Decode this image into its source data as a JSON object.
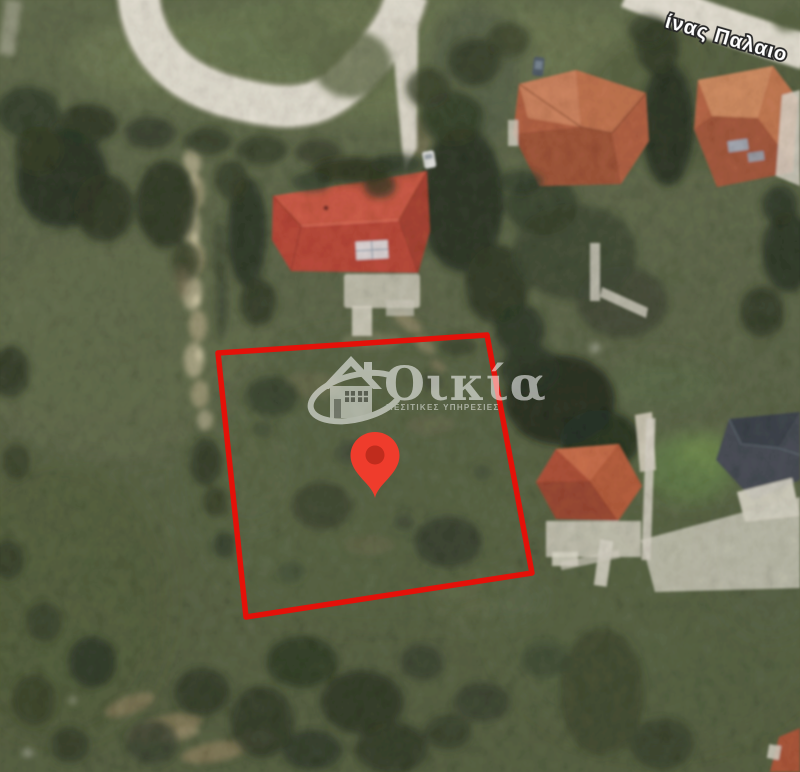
{
  "map": {
    "type": "satellite-aerial-view",
    "street_label": "ίνας Παλαιο",
    "parcel_outline": {
      "points": "218,353 487,335 532,573 246,617",
      "color": "#e41109"
    },
    "pin": {
      "transform": "translate(375,460)",
      "color": "#ef3c2c",
      "inner_color": "#ba2a1c"
    }
  },
  "watermark": {
    "brand": "Οικία",
    "subtitle": "ΜΕΣΙΤΙΚΕΣ ΥΠΗΡΕΣΙΕΣ",
    "color": "#ffffff",
    "icon": "house-logo-icon"
  },
  "palette": {
    "terrain_green": "#57623f",
    "road_beige": "#e4dfd0",
    "main_roof_red": "#c04532",
    "terracotta_roof": "#b85a3a",
    "dark_roof": "#3a4149"
  }
}
